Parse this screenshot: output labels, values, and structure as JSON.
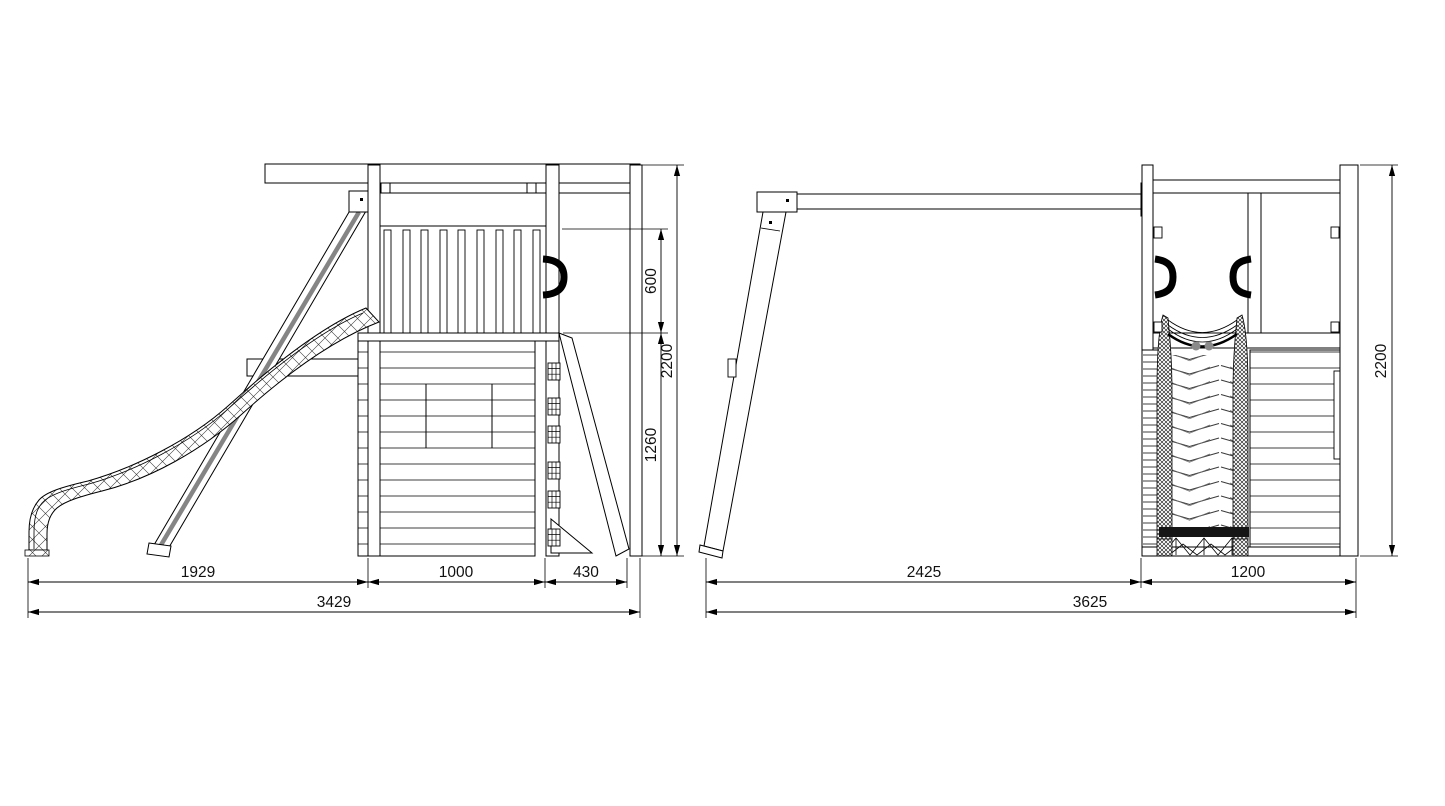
{
  "drawing": {
    "background": "#ffffff",
    "line_color": "#000000",
    "support_shade_color": "#858585",
    "roller_color": "#8a8a8a",
    "views": {
      "left": {
        "dims": {
          "slide_extent": "1929",
          "tower_width": "1000",
          "climbing_wall_extent": "430",
          "total_width": "3429",
          "railing_height": "600",
          "lower_wall_height": "1260",
          "total_height": "2200"
        }
      },
      "right": {
        "dims": {
          "swing_extent": "2425",
          "tower_width": "1200",
          "total_width": "3625",
          "total_height": "2200"
        }
      }
    }
  }
}
